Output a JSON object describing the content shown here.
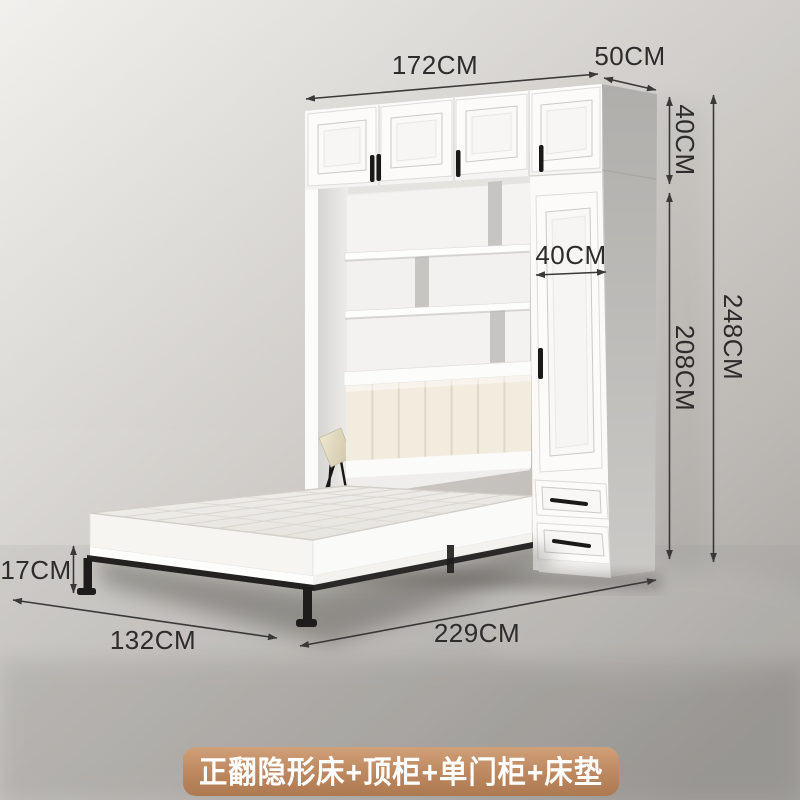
{
  "product": {
    "caption": "正翻隐形床+顶柜+单门柜+床垫"
  },
  "annotations": {
    "top_width": "172CM",
    "top_depth": "50CM",
    "top_cabinet_height": "40CM",
    "single_cabinet_width": "40CM",
    "lower_section_height": "208CM",
    "total_height": "248CM",
    "bed_frame_height": "17CM",
    "bed_width": "132CM",
    "open_depth": "229CM"
  },
  "colors": {
    "annotation_text": "#2d2c2a",
    "annotation_line": "#3a3937",
    "banner_background": "#c08b62",
    "banner_text": "#ffffff",
    "cabinet_white": "#fbfaf8",
    "cabinet_side_grey": "#b9b7b4",
    "headboard_cream": "#f2ecdf",
    "bed_frame_black": "#232220",
    "backdrop_light": "#f0efec",
    "backdrop_dark": "#a9a6a2"
  }
}
